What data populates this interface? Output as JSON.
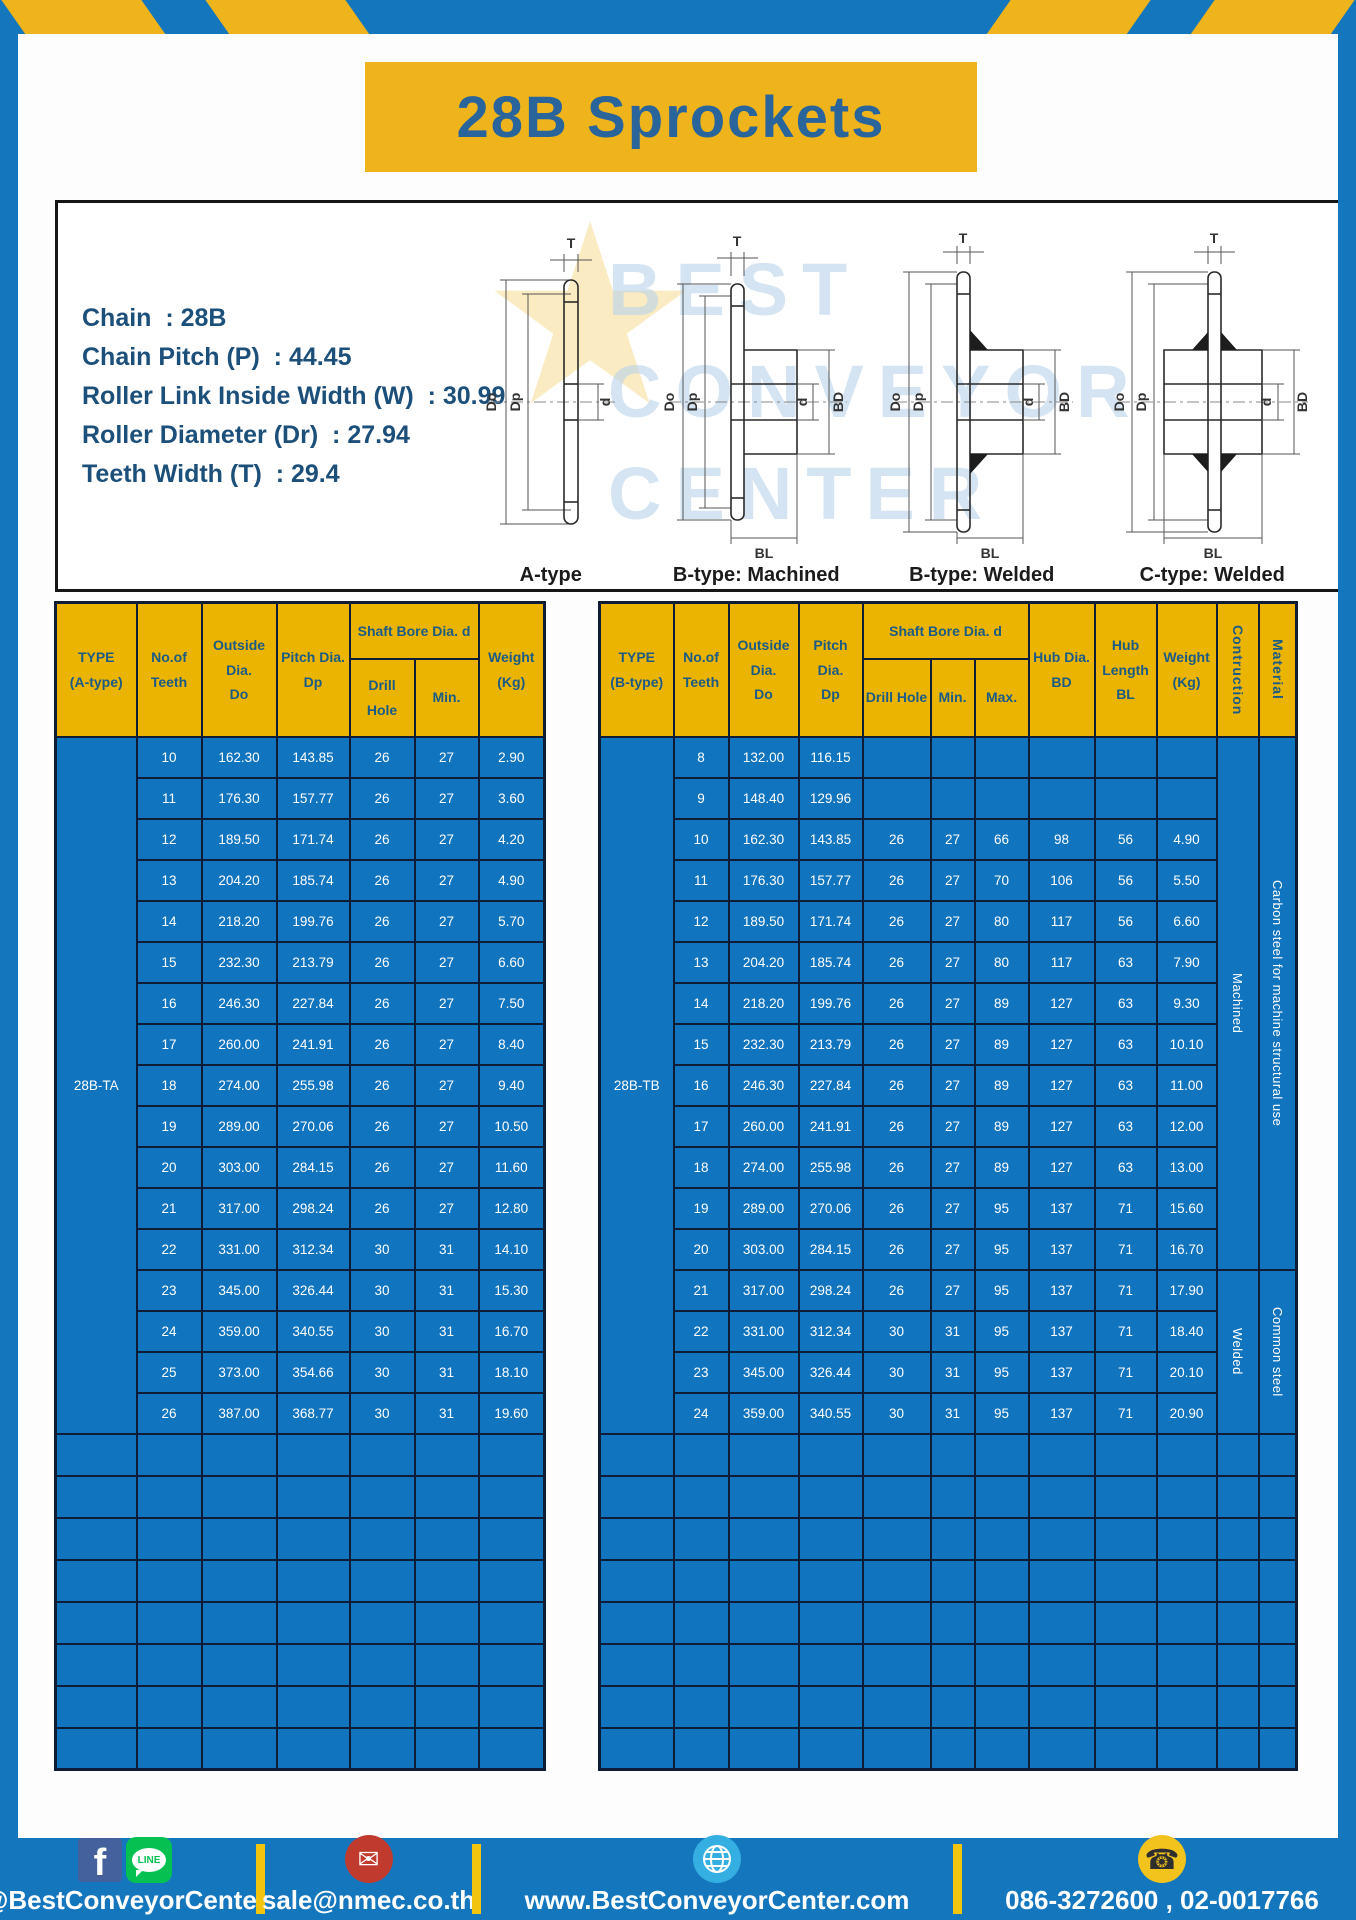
{
  "title": "28B Sprockets",
  "specs": {
    "lines": [
      "Chain  : 28B",
      "Chain Pitch (P)  : 44.45",
      "Roller Link Inside Width (W)  : 30.99",
      "Roller Diameter (Dr)  : 27.94",
      "Teeth Width (T)  : 29.4"
    ]
  },
  "diagrams": {
    "captions": [
      "A-type",
      "B-type: Machined",
      "B-type: Welded",
      "C-type: Welded"
    ],
    "labels": {
      "t": "T",
      "do": "Do",
      "dp": "Dp",
      "d": "d",
      "bd": "BD",
      "bl": "BL"
    },
    "watermark_star": "★",
    "watermark_text": "BEST\nCONVEYOR\nCENTER"
  },
  "tables": {
    "left": {
      "headers": {
        "type": "TYPE\n(A-type)",
        "teeth": "No.of\nTeeth",
        "outside": "Outside\nDia.\nDo",
        "pitch": "Pitch Dia.\nDp",
        "shaft_bore": "Shaft Bore Dia. d",
        "drill": "Drill Hole",
        "min": "Min.",
        "weight": "Weight\n(Kg)"
      },
      "type_label": "28B-TA",
      "rows": [
        [
          "10",
          "162.30",
          "143.85",
          "26",
          "27",
          "2.90"
        ],
        [
          "11",
          "176.30",
          "157.77",
          "26",
          "27",
          "3.60"
        ],
        [
          "12",
          "189.50",
          "171.74",
          "26",
          "27",
          "4.20"
        ],
        [
          "13",
          "204.20",
          "185.74",
          "26",
          "27",
          "4.90"
        ],
        [
          "14",
          "218.20",
          "199.76",
          "26",
          "27",
          "5.70"
        ],
        [
          "15",
          "232.30",
          "213.79",
          "26",
          "27",
          "6.60"
        ],
        [
          "16",
          "246.30",
          "227.84",
          "26",
          "27",
          "7.50"
        ],
        [
          "17",
          "260.00",
          "241.91",
          "26",
          "27",
          "8.40"
        ],
        [
          "18",
          "274.00",
          "255.98",
          "26",
          "27",
          "9.40"
        ],
        [
          "19",
          "289.00",
          "270.06",
          "26",
          "27",
          "10.50"
        ],
        [
          "20",
          "303.00",
          "284.15",
          "26",
          "27",
          "11.60"
        ],
        [
          "21",
          "317.00",
          "298.24",
          "26",
          "27",
          "12.80"
        ],
        [
          "22",
          "331.00",
          "312.34",
          "30",
          "31",
          "14.10"
        ],
        [
          "23",
          "345.00",
          "326.44",
          "30",
          "31",
          "15.30"
        ],
        [
          "24",
          "359.00",
          "340.55",
          "30",
          "31",
          "16.70"
        ],
        [
          "25",
          "373.00",
          "354.66",
          "30",
          "31",
          "18.10"
        ],
        [
          "26",
          "387.00",
          "368.77",
          "30",
          "31",
          "19.60"
        ]
      ],
      "empty_rows": 8
    },
    "right": {
      "headers": {
        "type": "TYPE\n(B-type)",
        "teeth": "No.of\nTeeth",
        "outside": "Outside\nDia.\nDo",
        "pitch": "Pitch Dia.\nDp",
        "shaft_bore": "Shaft Bore Dia. d",
        "drill": "Drill Hole",
        "min": "Min.",
        "max": "Max.",
        "hub_dia": "Hub Dia.\nBD",
        "hub_len": "Hub\nLength\nBL",
        "weight": "Weight\n(Kg)",
        "construction": "Contruction",
        "material": "Material"
      },
      "type_label": "28B-TB",
      "rows": [
        [
          "8",
          "132.00",
          "116.15",
          "",
          "",
          "",
          "",
          "",
          ""
        ],
        [
          "9",
          "148.40",
          "129.96",
          "",
          "",
          "",
          "",
          "",
          ""
        ],
        [
          "10",
          "162.30",
          "143.85",
          "26",
          "27",
          "66",
          "98",
          "56",
          "4.90"
        ],
        [
          "11",
          "176.30",
          "157.77",
          "26",
          "27",
          "70",
          "106",
          "56",
          "5.50"
        ],
        [
          "12",
          "189.50",
          "171.74",
          "26",
          "27",
          "80",
          "117",
          "56",
          "6.60"
        ],
        [
          "13",
          "204.20",
          "185.74",
          "26",
          "27",
          "80",
          "117",
          "63",
          "7.90"
        ],
        [
          "14",
          "218.20",
          "199.76",
          "26",
          "27",
          "89",
          "127",
          "63",
          "9.30"
        ],
        [
          "15",
          "232.30",
          "213.79",
          "26",
          "27",
          "89",
          "127",
          "63",
          "10.10"
        ],
        [
          "16",
          "246.30",
          "227.84",
          "26",
          "27",
          "89",
          "127",
          "63",
          "11.00"
        ],
        [
          "17",
          "260.00",
          "241.91",
          "26",
          "27",
          "89",
          "127",
          "63",
          "12.00"
        ],
        [
          "18",
          "274.00",
          "255.98",
          "26",
          "27",
          "89",
          "127",
          "63",
          "13.00"
        ],
        [
          "19",
          "289.00",
          "270.06",
          "26",
          "27",
          "95",
          "137",
          "71",
          "15.60"
        ],
        [
          "20",
          "303.00",
          "284.15",
          "26",
          "27",
          "95",
          "137",
          "71",
          "16.70"
        ],
        [
          "21",
          "317.00",
          "298.24",
          "26",
          "27",
          "95",
          "137",
          "71",
          "17.90"
        ],
        [
          "22",
          "331.00",
          "312.34",
          "30",
          "31",
          "95",
          "137",
          "71",
          "18.40"
        ],
        [
          "23",
          "345.00",
          "326.44",
          "30",
          "31",
          "95",
          "137",
          "71",
          "20.10"
        ],
        [
          "24",
          "359.00",
          "340.55",
          "30",
          "31",
          "95",
          "137",
          "71",
          "20.90"
        ]
      ],
      "construction": [
        {
          "label": "Machined",
          "span": 13
        },
        {
          "label": "Welded",
          "span": 4
        }
      ],
      "material": [
        {
          "label": "Carbon steel for  machine structural use",
          "span": 13
        },
        {
          "label": "Common steel",
          "span": 4
        }
      ],
      "empty_rows": 8
    }
  },
  "footer": {
    "facebook_glyph": "f",
    "line_glyph": "LINE",
    "social_handle": "@BestConveyorCenter",
    "mail_glyph": "✉",
    "email": "sale@nmec.co.th",
    "website": "www.BestConveyorCenter.com",
    "phone_glyph": "☎",
    "phone": "086-3272600 , 02-0017766"
  },
  "colors": {
    "frame_blue": "#1476BD",
    "gold": "#EFB41B",
    "header_gold": "#EAB400",
    "cell_blue": "#1174BE",
    "grid_line": "#0E1C36",
    "header_text": "#1D5B85",
    "title_text": "#29649B",
    "spec_text": "#1C4F7A",
    "divider_yellow": "#F2C40E",
    "facebook_blue": "#44619D",
    "line_green": "#06C152",
    "mail_red": "#C13A2E",
    "globe_blue": "#35AEE2",
    "phone_yellow": "#F2C31D"
  }
}
